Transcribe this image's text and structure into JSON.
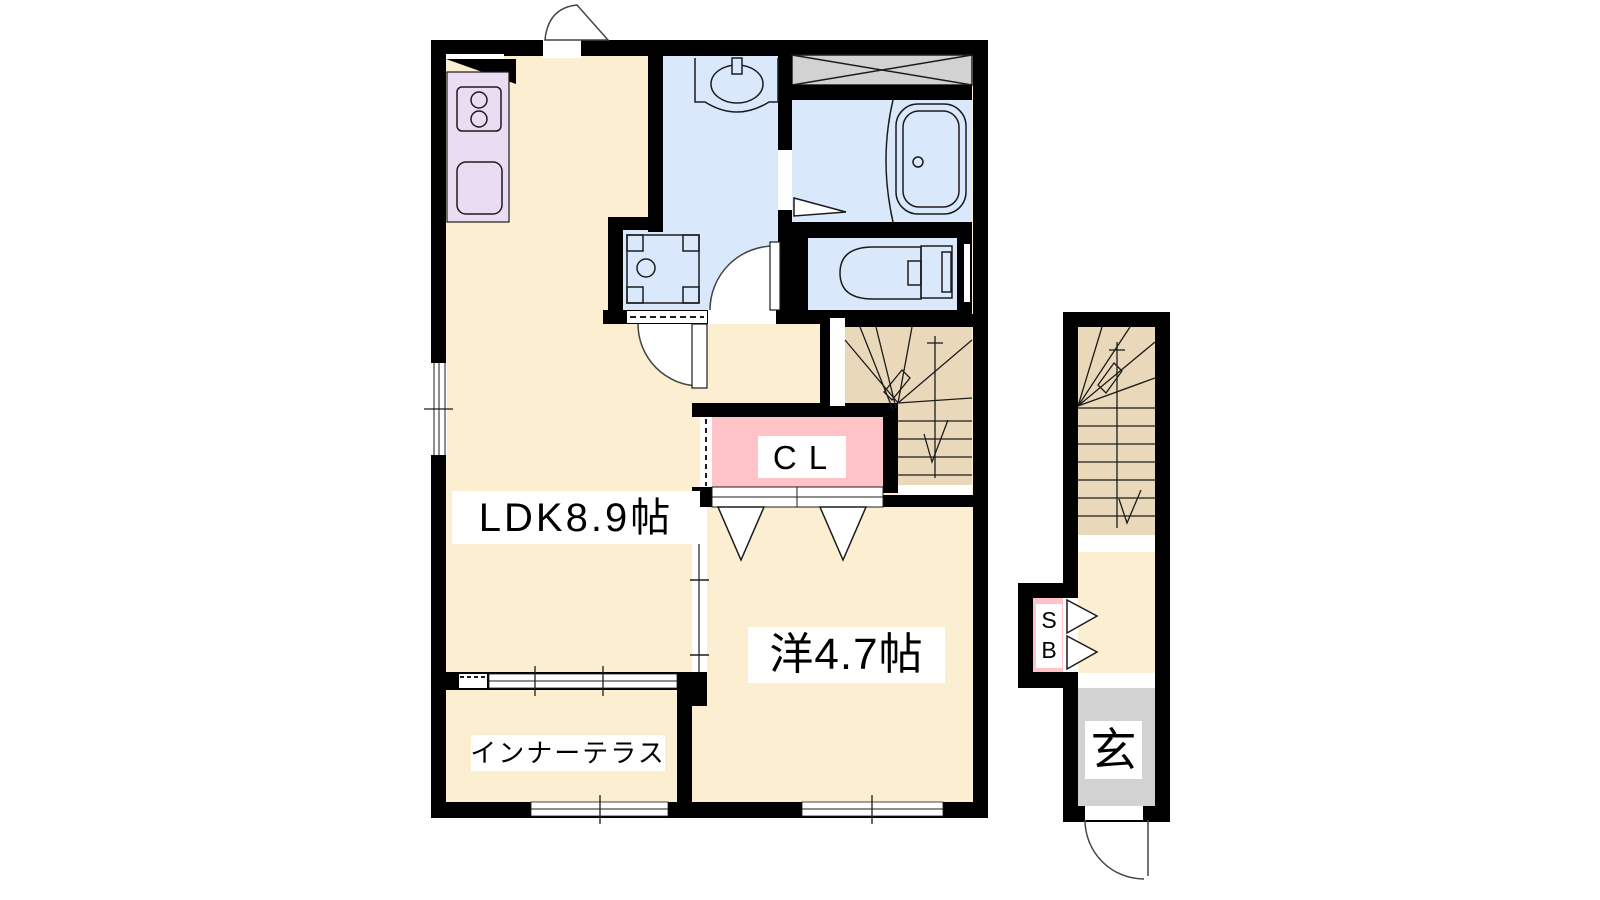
{
  "plan": {
    "rooms": {
      "ldk_label": "LDK8.9帖",
      "western_room_label": "洋4.7帖",
      "closet_label": "CL",
      "inner_terrace_label": "インナーテラス",
      "shoe_box_label": "SB",
      "entrance_label": "玄"
    },
    "colors": {
      "floor_cream": "#FBEED1",
      "kitchen_lavender": "#E9DCF3",
      "wet_area_blue": "#D9E8FA",
      "closet_pink": "#FFC2C7",
      "stair_tan": "#E9D8B9",
      "entrance_gray": "#D2D2D2",
      "wall_black": "#000000",
      "line": "#1c1c1c",
      "background": "#FFFFFF"
    },
    "fixtures": [
      "stove-icon",
      "kitchen-sink-icon",
      "washbasin-icon",
      "washing-machine-pan-icon",
      "bathtub-icon",
      "toilet-icon",
      "hatched-storage-icon",
      "staircase-main",
      "staircase-annex",
      "closet-door-triangles",
      "entry-door-arc",
      "sliding-windows"
    ]
  }
}
